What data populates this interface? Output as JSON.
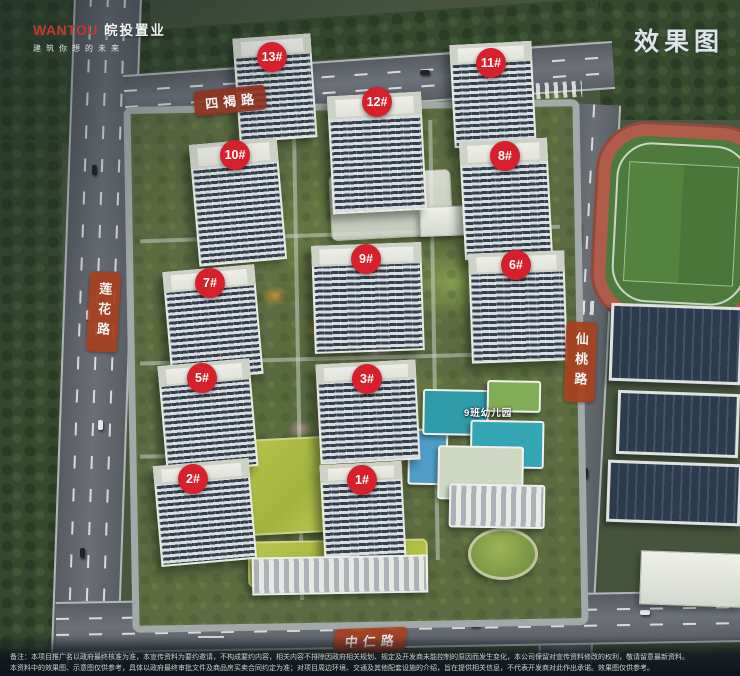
{
  "brand": {
    "logo_en": "WANTOU",
    "logo_cn": "皖投置业",
    "tagline": "建筑你想的未来"
  },
  "watermark": "效果图",
  "road_labels": {
    "top": "四褐路",
    "left": "莲花路",
    "right": "仙桃路",
    "bottom": "中仁路"
  },
  "poi": {
    "kindergarten": "9班幼儿园"
  },
  "markers": [
    {
      "label": "13#",
      "x": 272,
      "y": 57
    },
    {
      "label": "12#",
      "x": 377,
      "y": 102
    },
    {
      "label": "11#",
      "x": 491,
      "y": 63
    },
    {
      "label": "10#",
      "x": 235,
      "y": 155
    },
    {
      "label": "8#",
      "x": 505,
      "y": 156
    },
    {
      "label": "9#",
      "x": 366,
      "y": 259
    },
    {
      "label": "6#",
      "x": 516,
      "y": 265
    },
    {
      "label": "7#",
      "x": 210,
      "y": 283
    },
    {
      "label": "5#",
      "x": 202,
      "y": 378
    },
    {
      "label": "3#",
      "x": 367,
      "y": 379
    },
    {
      "label": "2#",
      "x": 193,
      "y": 479
    },
    {
      "label": "1#",
      "x": 362,
      "y": 480
    }
  ],
  "disclaimer": {
    "line1": "备注：本项目推广名以政府最终核准为准，本宣传资料为要约邀请，不构成要约内容，相关内容不排除因政府相关规划、规定及开发商未能控制的原因而发生变化，本公司保留对宣传资料修改的权利，敬请留意最新资料。",
    "line2": "本资料中的效果图、示意图仅供参考，具体以政府最终审批文件及商品房买卖合同约定为准；对项目周边环境、交通及其他配套设施的介绍，旨在提供相关信息，不代表开发商对此作出承诺。效果图仅供参考。"
  },
  "colors": {
    "marker_red": "#d6202b",
    "road_label": "#a8401f",
    "track_red": "#b05c4b",
    "field_green": "#4e7a3e",
    "lawn_green": "#b0bd45",
    "water_blue": "#4f9ec7",
    "kindergarten_teal": "#2f9aa8"
  }
}
